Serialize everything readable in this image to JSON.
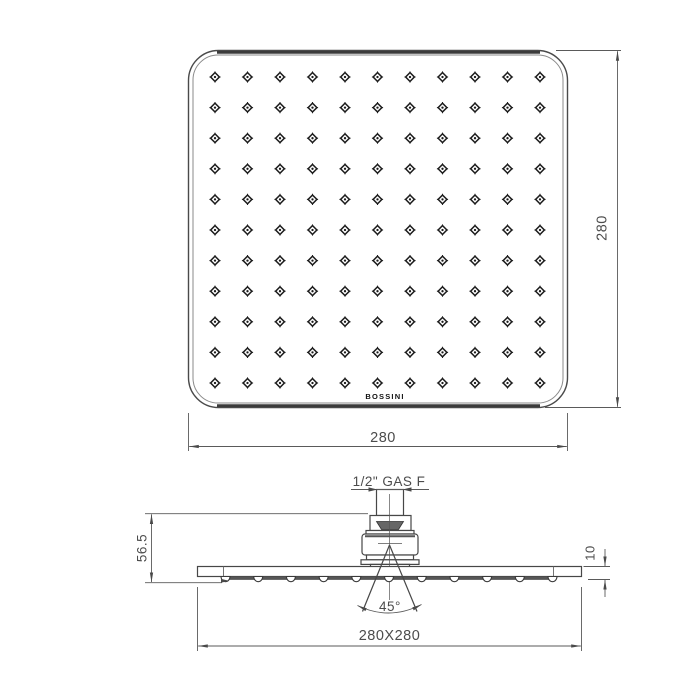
{
  "drawing": {
    "views": {
      "top": {
        "description": "front face of square shower head",
        "dim_width": "280",
        "dim_height": "280",
        "logo": "BOSSINI",
        "nozzle_grid": {
          "rows": 11,
          "cols": 11
        }
      },
      "side": {
        "description": "side profile with ceiling connector",
        "connection_label": "1/2\" GAS F",
        "dim_head_height": "56.5",
        "dim_edge_thickness": "10",
        "spray_angle": "45°",
        "dim_footprint": "280X280",
        "nozzle_count": 11
      }
    },
    "colors": {
      "line": "#474747",
      "dim_line": "#5a5a5a",
      "dim_text": "#4c4c4c",
      "thick_edge": "#3b3b3b"
    }
  }
}
